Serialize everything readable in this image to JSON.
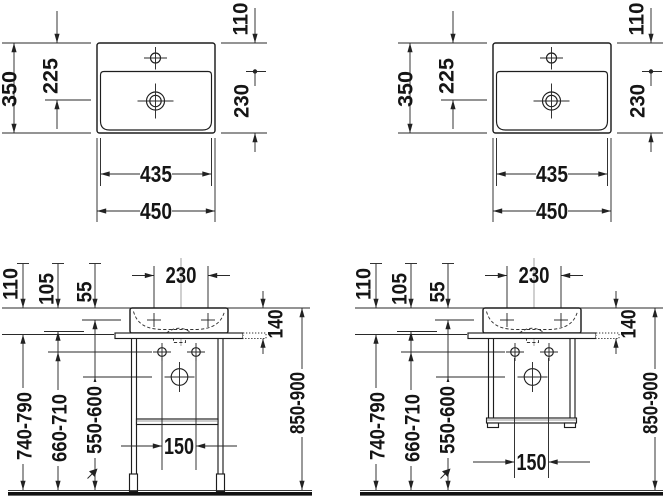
{
  "plan_view": {
    "overall_width": "450",
    "bowl_width": "435",
    "overall_depth": "350",
    "drain_center_offset": "225",
    "deck_depth": "110",
    "bowl_depth": "230"
  },
  "front_view": {
    "tap_hole_spacing": "230",
    "rim_to_tap_holes": "55",
    "rim_to_console_plate": "105",
    "rim_to_underside": "110",
    "basin_height_with_plate": "140",
    "fixing_hole_spacing": "150",
    "floor_to_underside": "740-790",
    "floor_to_fixing_holes": "660-710",
    "floor_to_drain": "550-600",
    "floor_to_rim": "850-900"
  }
}
